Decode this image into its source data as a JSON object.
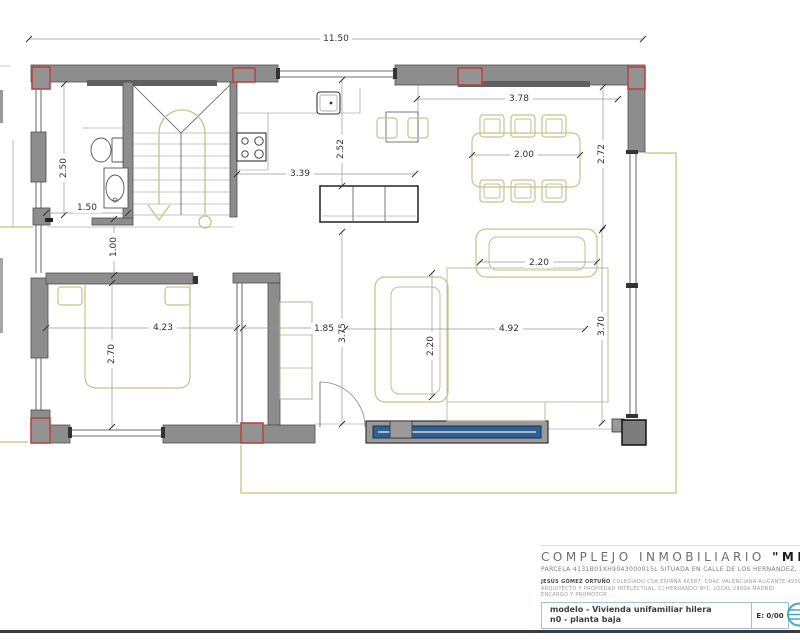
{
  "plan": {
    "dimensions": {
      "total_width": "11.50",
      "bath_depth": "2.50",
      "bath_width": "1.50",
      "hall_width": "1.00",
      "bedroom_depth": "2.70",
      "bedroom_width": "4.23",
      "kitchen_width": "3.39",
      "kitchen_depth": "2.52",
      "dining_width": "3.78",
      "dining_table_width": "2.00",
      "dining_depth": "2.72",
      "loveseat_width": "2.20",
      "hall2_width": "1.85",
      "living_inner_depth": "3.75",
      "sofa_depth": "2.20",
      "living_width": "4.92",
      "living_depth": "3.70"
    }
  },
  "titleblock": {
    "project_title_regular": "COMPLEJO INMOBILIARIO ",
    "project_title_bold": "\"MIRADOR DEL MAR\"",
    "parcel_line": "PARCELA 4131B01XH9043000015L SITUADA EN CALLE DE LOS HERNÁNDEZ, 36.  SAN MIGUEL DE SALINAS",
    "architect_line1_bold": "JESÚS GÓMEZ ORTUÑO ",
    "architect_line1": "COLEGIADO CSA ESPAÑA 66587. COAC VALENCIANA-ALICANTE 4939. COA MADRID-SUBD. COA BALEARES 77593",
    "architect_line2": "ARQUITECTO  Y  PROPIEDAD  INTELECTUAL.    C/ HERNANDO  Nº1,  LOCAL  28004    MADRID",
    "architect_line3": "ENCARGO  Y  PROMOTOR  .",
    "model_line1": "modelo - Vivienda unifamiliar hilera",
    "model_line2": "n0  - planta baja",
    "scale_label": "E: 0/00"
  },
  "colors": {
    "wall_gray": "#8d8d8d",
    "column_red": "#b8463f",
    "furniture_olive": "#c6c389",
    "glass_blue": "#2e6092",
    "brand_cyan": "#45a5c6"
  }
}
